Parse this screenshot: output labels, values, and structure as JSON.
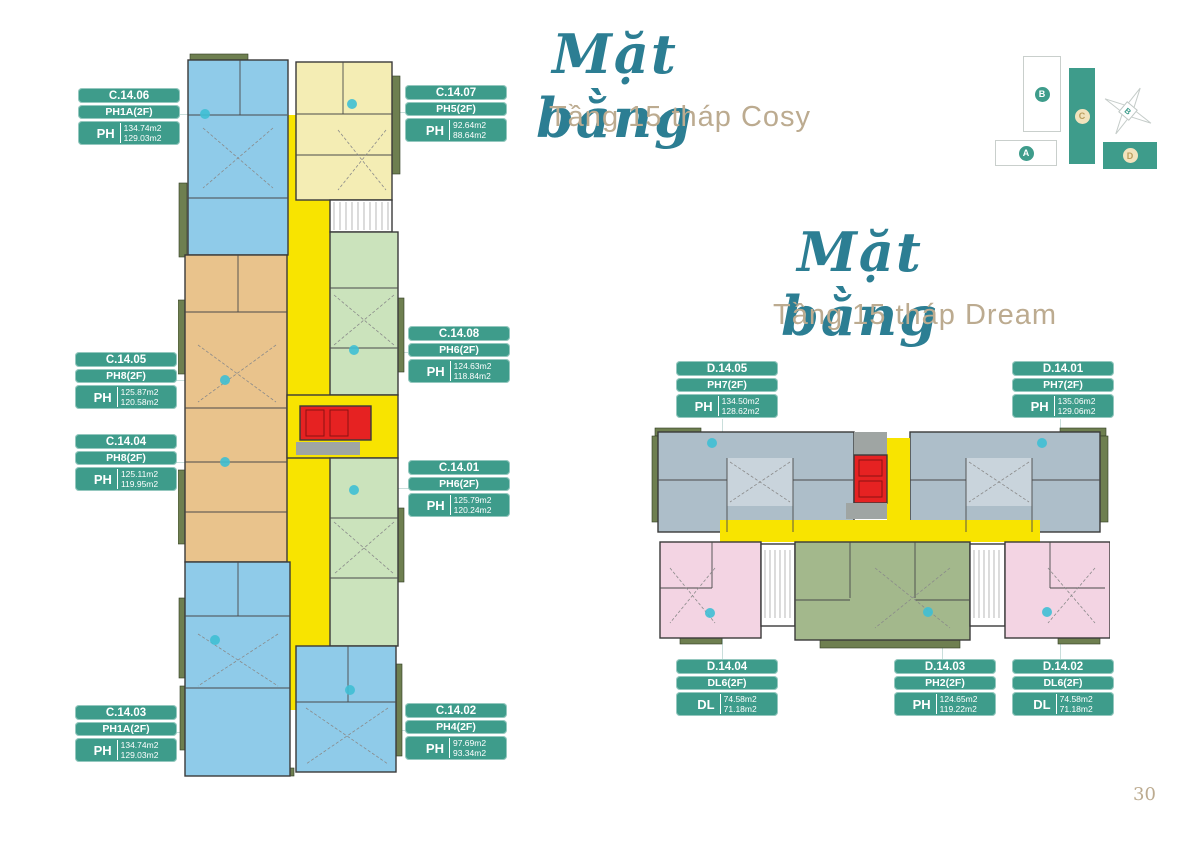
{
  "page_number": "30",
  "colors": {
    "label_teal": "#3E9C8B",
    "title_script": "#2C7E93",
    "title_subtitle": "#BCAB90",
    "unit_blue": "#8FCBE9",
    "unit_pale_yellow": "#F4EDB4",
    "unit_orange": "#E9C38C",
    "unit_green_light": "#CBE3BC",
    "unit_green_olive": "#A3B88C",
    "unit_gray": "#ADBEC9",
    "unit_pink": "#F3D4E3",
    "corridor_yellow": "#F8E400",
    "core_red": "#E62222",
    "balcony_olive": "#6E7F50",
    "dot_cyan": "#3FBFD4"
  },
  "cosy": {
    "title_script": "Mặt bằng",
    "title_subtitle": "Tầng 15 tháp Cosy",
    "labels": [
      {
        "code": "C.14.06",
        "type": "PH1A(2F)",
        "tier": "PH",
        "area1": "134.74m2",
        "area2": "129.03m2"
      },
      {
        "code": "C.14.07",
        "type": "PH5(2F)",
        "tier": "PH",
        "area1": "92.64m2",
        "area2": "88.64m2"
      },
      {
        "code": "C.14.05",
        "type": "PH8(2F)",
        "tier": "PH",
        "area1": "125.87m2",
        "area2": "120.58m2"
      },
      {
        "code": "C.14.08",
        "type": "PH6(2F)",
        "tier": "PH",
        "area1": "124.63m2",
        "area2": "118.84m2"
      },
      {
        "code": "C.14.04",
        "type": "PH8(2F)",
        "tier": "PH",
        "area1": "125.11m2",
        "area2": "119.95m2"
      },
      {
        "code": "C.14.01",
        "type": "PH6(2F)",
        "tier": "PH",
        "area1": "125.79m2",
        "area2": "120.24m2"
      },
      {
        "code": "C.14.03",
        "type": "PH1A(2F)",
        "tier": "PH",
        "area1": "134.74m2",
        "area2": "129.03m2"
      },
      {
        "code": "C.14.02",
        "type": "PH4(2F)",
        "tier": "PH",
        "area1": "97.69m2",
        "area2": "93.34m2"
      }
    ]
  },
  "dream": {
    "title_script": "Mặt bằng",
    "title_subtitle": "Tầng 15 tháp Dream",
    "labels": [
      {
        "code": "D.14.05",
        "type": "PH7(2F)",
        "tier": "PH",
        "area1": "134.50m2",
        "area2": "128.62m2"
      },
      {
        "code": "D.14.01",
        "type": "PH7(2F)",
        "tier": "PH",
        "area1": "135.06m2",
        "area2": "129.06m2"
      },
      {
        "code": "D.14.04",
        "type": "DL6(2F)",
        "tier": "DL",
        "area1": "74.58m2",
        "area2": "71.18m2"
      },
      {
        "code": "D.14.03",
        "type": "PH2(2F)",
        "tier": "PH",
        "area1": "124.65m2",
        "area2": "119.22m2"
      },
      {
        "code": "D.14.02",
        "type": "DL6(2F)",
        "tier": "DL",
        "area1": "74.58m2",
        "area2": "71.18m2"
      }
    ]
  },
  "locator": {
    "building_a": "A",
    "building_b": "B",
    "building_c": "C",
    "building_d": "D",
    "compass": "B"
  }
}
